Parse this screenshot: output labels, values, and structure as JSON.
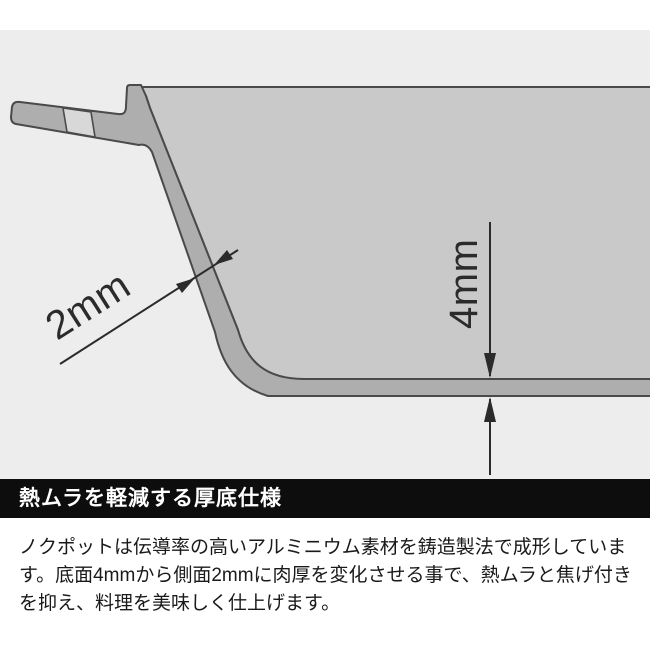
{
  "illustration": {
    "description": "pot-cross-section-thickness-diagram",
    "annotations": {
      "side_thickness": "2mm",
      "bottom_thickness": "4mm"
    },
    "colors": {
      "background": "#ededed",
      "top_strip": "#ffffff",
      "interior": "#c9c9c9",
      "metal": "#aeaeae",
      "handle_band": "#d8d8d8",
      "outline": "#4a4a4a",
      "dimension": "#2b2b2b"
    }
  },
  "header": {
    "title": "熱ムラを軽減する厚底仕様",
    "bg": "#0d0d0d",
    "color": "#ffffff"
  },
  "body": {
    "text": "ノクポットは伝導率の高いアルミニウム素材を鋳造製法で成形しています。底面4mmから側面2mmに肉厚を変化させる事で、熱ムラと焦げ付きを抑え、料理を美味しく仕上げます。",
    "lines": [
      "ノクポットは伝導率の高いアルミニウム素材を鋳造製法で成形していま",
      "す。底面4mmから側面2mmに肉厚を変化させる事で、熱ムラと焦げ付き",
      "を抑え、料理を美味しく仕上げます。"
    ]
  }
}
